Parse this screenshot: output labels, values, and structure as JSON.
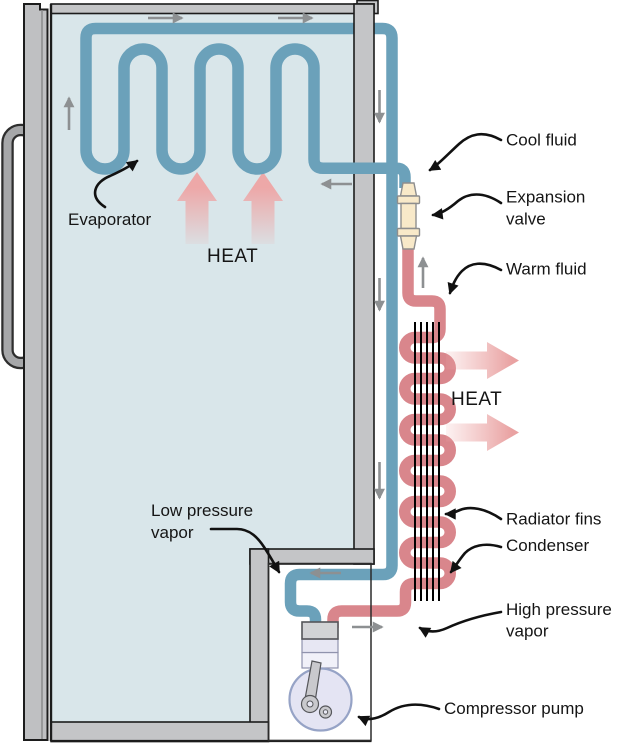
{
  "labels": {
    "evaporator": "Evaporator",
    "heat_inside": "HEAT",
    "heat_outside": "HEAT",
    "cool_fluid": "Cool fluid",
    "expansion_valve_line1": "Expansion",
    "expansion_valve_line2": "valve",
    "warm_fluid": "Warm fluid",
    "radiator_fins": "Radiator fins",
    "condenser": "Condenser",
    "high_pressure_line1": "High pressure",
    "high_pressure_line2": "vapor",
    "low_pressure_line1": "Low pressure",
    "low_pressure_line2": "vapor",
    "compressor_pump": "Compressor pump"
  },
  "colors": {
    "pipe_cold": "#6ba1ba",
    "pipe_hot": "#d9868c",
    "interior": "#d9e6ea",
    "frame": "#c4c5c7",
    "frame_edge": "#1c1c1c",
    "heat_arrow": "#eda8a8",
    "flow_arrow": "#8d9092",
    "valve_body": "#f8e9c9",
    "compressor_body": "#e4e4f3",
    "fins": "#000000",
    "label_text": "#151515"
  }
}
